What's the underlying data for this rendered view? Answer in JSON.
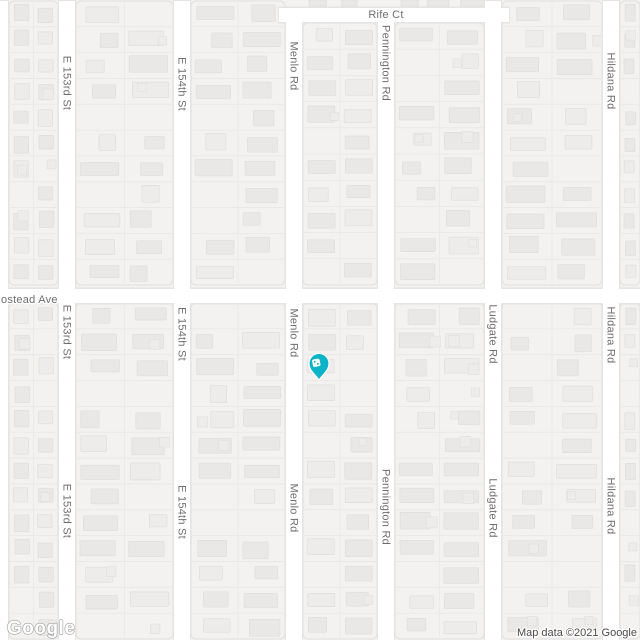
{
  "colors": {
    "background": "#f3f2f0",
    "road_fill": "#ffffff",
    "road_casing": "#e5e4e2",
    "block_outline": "#e1e0de",
    "parcel_line": "#e8e7e5",
    "building_fill": "#e9e8e6",
    "building_fill_alt": "#edecea",
    "building_stroke": "#dfdedc",
    "street_label": "#6e6e6e",
    "poi_teal": "#0db3c6",
    "poi_text_teal": "#0d8d9b",
    "park_green": "#34a853",
    "marker_red": "#ea4335",
    "marker_dot": "#a33227"
  },
  "streets": {
    "vertical": [
      {
        "name": "E 153rd St",
        "x": 67,
        "y_start": 0,
        "label_ys": [
          83,
          332,
          511
        ]
      },
      {
        "name": "E 154th St",
        "x": 182,
        "y_start": 0,
        "label_ys": [
          84,
          334,
          512
        ]
      },
      {
        "name": "Menlo Rd",
        "x": 294,
        "y_start": 8,
        "label_ys": [
          66,
          333,
          508
        ]
      },
      {
        "name": "Pennington Rd",
        "x": 386,
        "y_start": 8,
        "label_ys": [
          63,
          507
        ]
      },
      {
        "name": "Ludgate Rd",
        "x": 493,
        "y_start": 0,
        "label_ys": [
          334,
          508
        ]
      },
      {
        "name": "Hildana Rd",
        "x": 611,
        "y_start": 0,
        "label_ys": [
          81,
          335,
          506
        ]
      },
      {
        "name": "",
        "x": 0,
        "y_start": 0,
        "label_ys": []
      }
    ],
    "horizontal": [
      {
        "name": "Rife Ct",
        "y": 15,
        "x_start": 287,
        "x_end": 501,
        "label_x": 386,
        "label_y": 18,
        "label_anchor": "middle"
      },
      {
        "name": "ostead Ave",
        "y": 296,
        "x_start": -10,
        "x_end": 650,
        "label_x": 1,
        "label_y": 303,
        "label_anchor": "start"
      }
    ]
  },
  "marker": {
    "x": 321,
    "head_y": 291,
    "tip_y": 325,
    "radius": 13
  },
  "pois": [
    {
      "id": "rw-magic",
      "label": "RW Magic",
      "icon": "dice-icon",
      "x": 319,
      "y": 363.5,
      "label_x": 331,
      "label_y": 378
    },
    {
      "id": "park",
      "label": "Menlo Tot Lot",
      "icon": "park-tree-icon",
      "x": 295,
      "y": 639.5,
      "label_x": 308,
      "label_y": 648
    }
  ],
  "branding": {
    "logo_text": "Google",
    "attribution_text": "Map data ©2021 Google"
  }
}
